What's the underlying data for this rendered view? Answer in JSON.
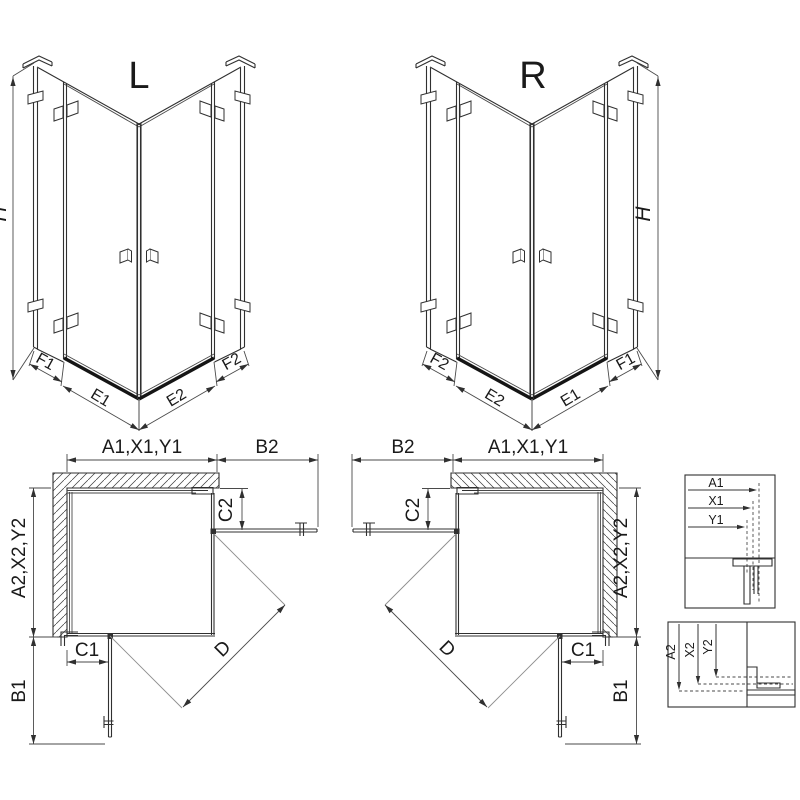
{
  "page": {
    "background": "#ffffff"
  },
  "views": {
    "iso_left": {
      "title": "L",
      "height_label": "H",
      "bottom_labels": {
        "f1": "F1",
        "e1": "E1",
        "e2": "E2",
        "f2": "F2"
      }
    },
    "iso_right": {
      "title": "R",
      "height_label": "H",
      "bottom_labels": {
        "f2": "F2",
        "e2": "E2",
        "e1": "E1",
        "f1": "F1"
      }
    },
    "plan_left": {
      "top_width": "A1,X1,Y1",
      "door_open_width": "B2",
      "fixed_panel_side": "C2",
      "side_depth": "A2,X2,Y2",
      "fixed_panel_bottom": "C1",
      "door_open_depth": "B1",
      "diagonal": "D"
    },
    "plan_right": {
      "top_width": "A1,X1,Y1",
      "door_open_width": "B2",
      "fixed_panel_side": "C2",
      "side_depth": "A2,X2,Y2",
      "fixed_panel_bottom": "C1",
      "door_open_depth": "B1",
      "diagonal": "D"
    },
    "detail_width": {
      "labels": {
        "a1": "A1",
        "x1": "X1",
        "y1": "Y1"
      }
    },
    "detail_depth": {
      "labels": {
        "a2": "A2",
        "x2": "X2",
        "y2": "Y2"
      }
    }
  },
  "colors": {
    "line": "#303030",
    "dim_line": "#4a4a4a",
    "swing_line": "#8f8f8f",
    "rail": "#151515",
    "detail_arrow": "#9a9a9a",
    "text": "#1a1a1a",
    "background": "#ffffff"
  }
}
